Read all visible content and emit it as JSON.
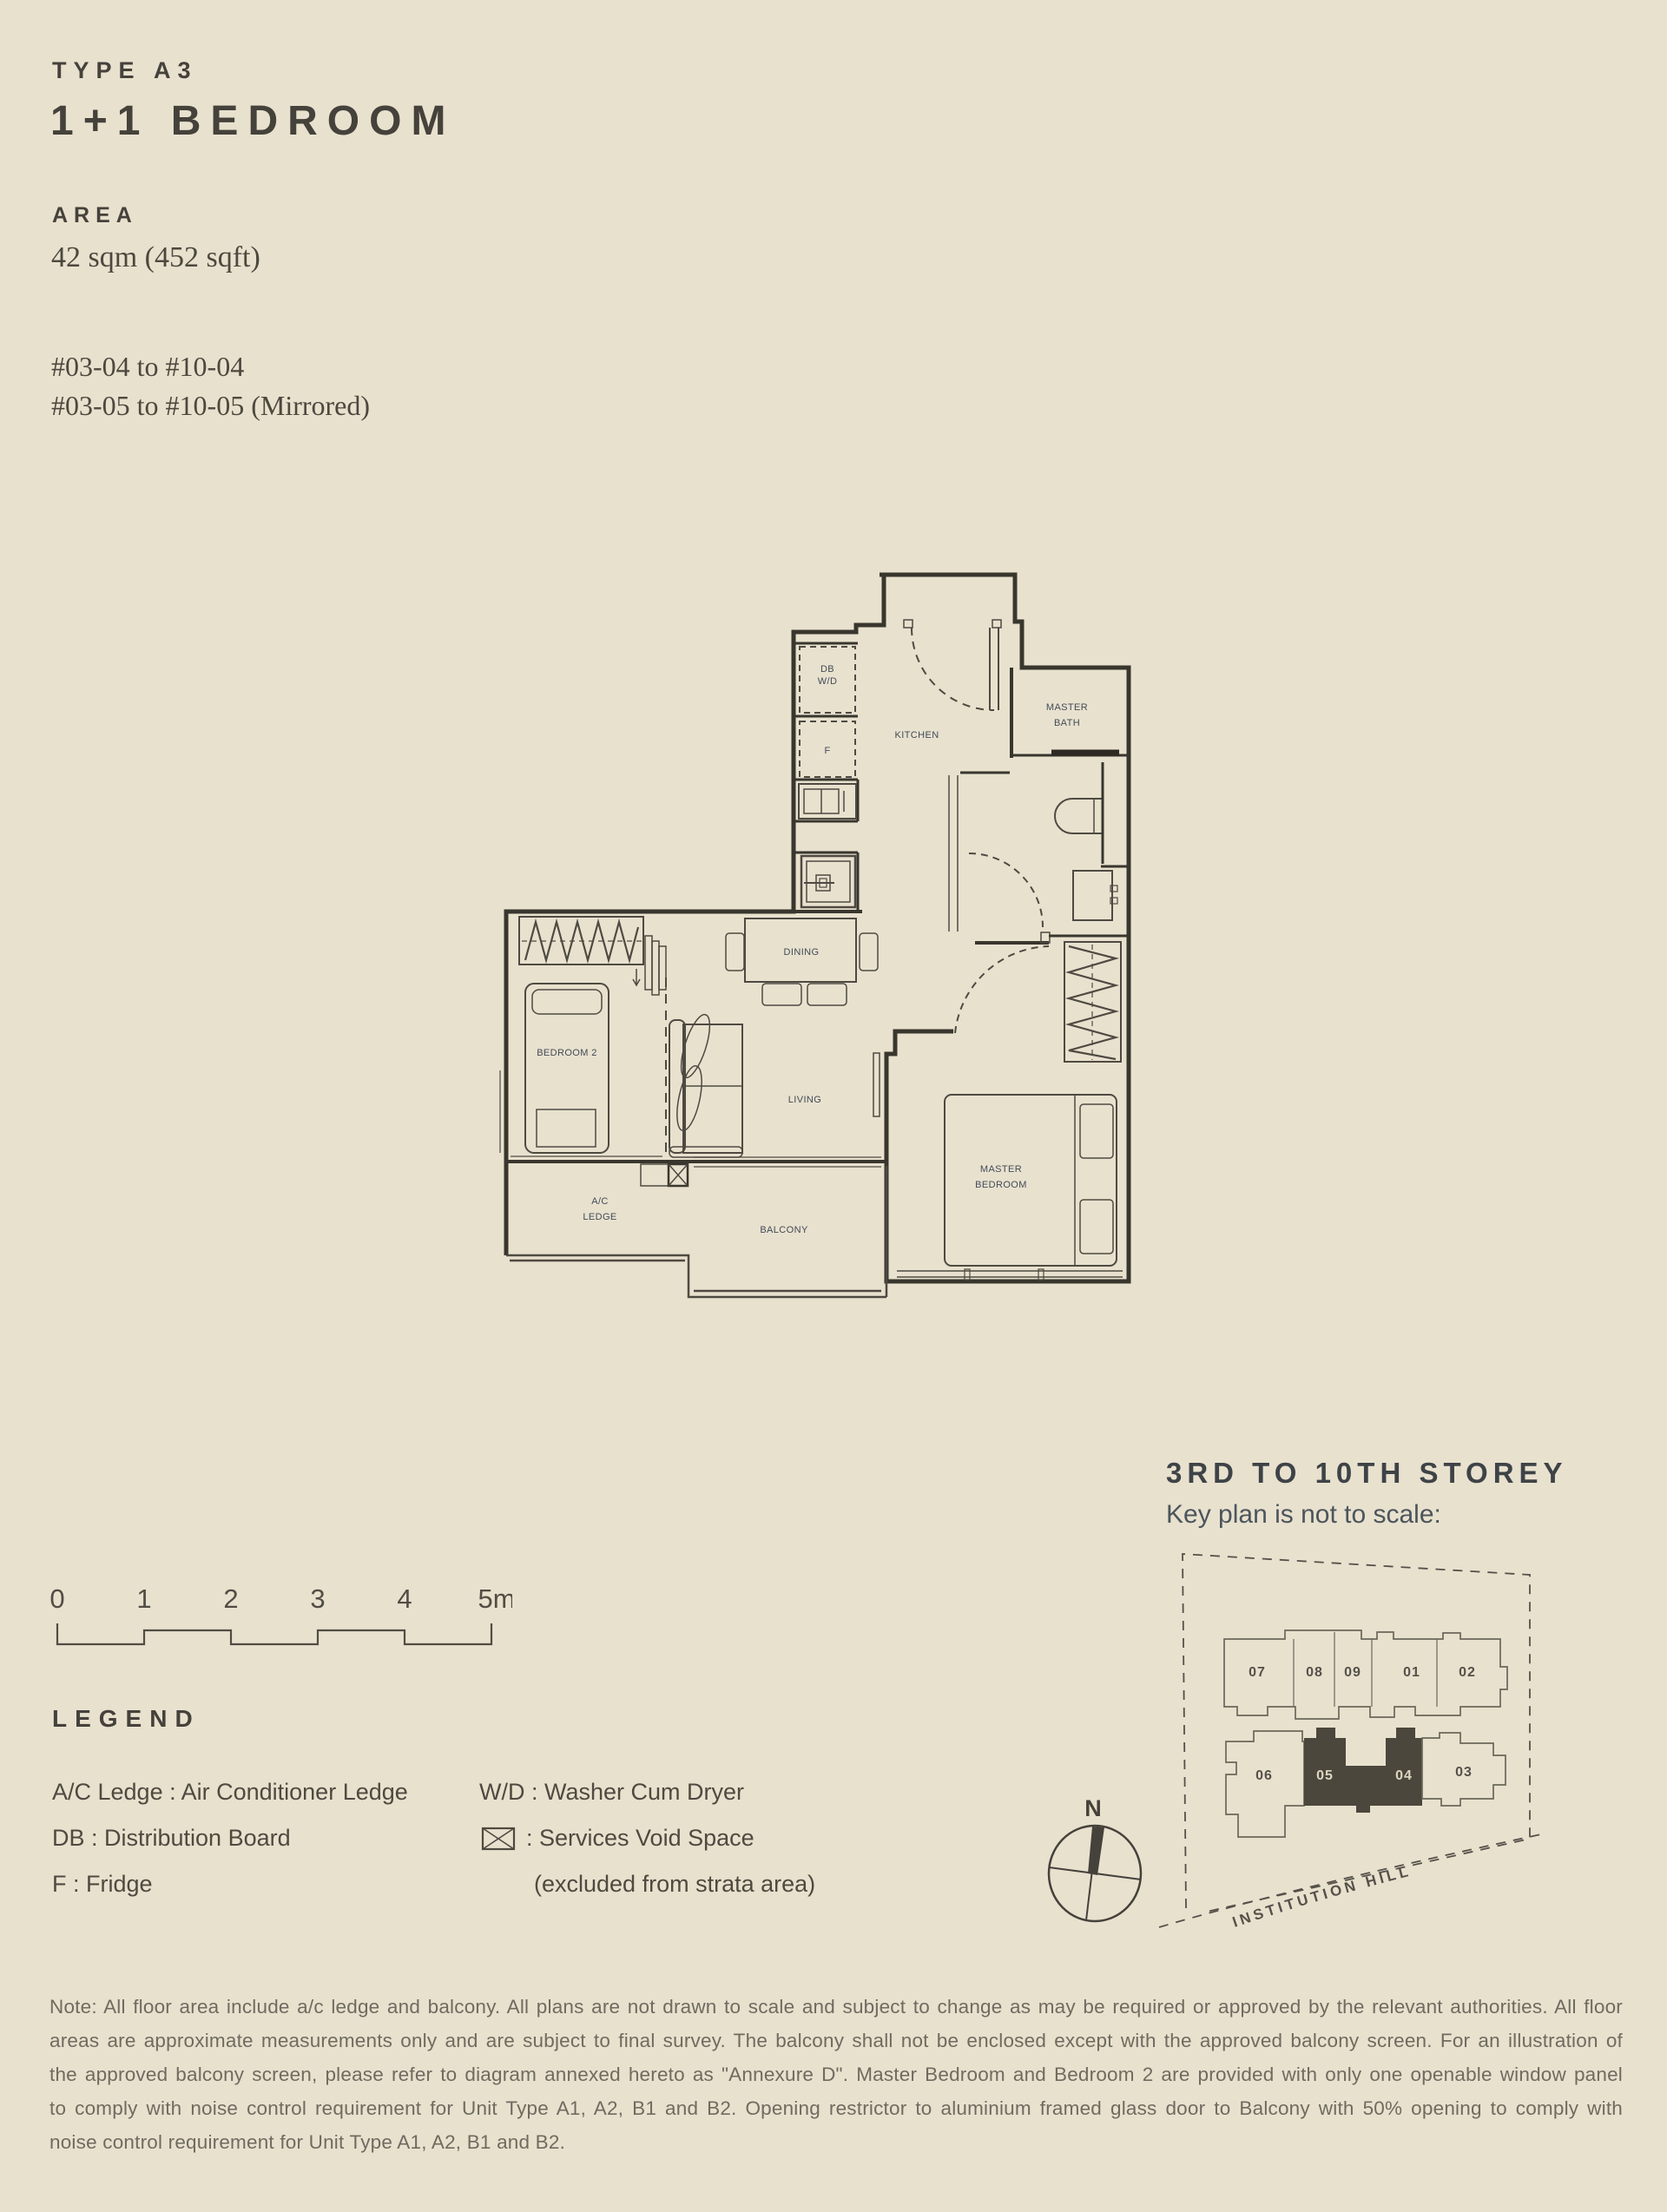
{
  "header": {
    "type_label": "TYPE A3",
    "title": "1+1 BEDROOM",
    "area_heading": "AREA",
    "area_value": "42 sqm (452 sqft)",
    "units_line1": "#03-04 to #10-04",
    "units_line2": "#03-05 to #10-05 (Mirrored)"
  },
  "plan": {
    "rooms": {
      "kitchen": "KITCHEN",
      "master_bath_l1": "MASTER",
      "master_bath_l2": "BATH",
      "dining": "DINING",
      "living": "LIVING",
      "bedroom2": "BEDROOM 2",
      "master_bedroom_l1": "MASTER",
      "master_bedroom_l2": "BEDROOM",
      "ac_ledge_l1": "A/C",
      "ac_ledge_l2": "LEDGE",
      "balcony": "BALCONY",
      "db_l1": "DB",
      "db_l2": "W/D",
      "fridge": "F"
    }
  },
  "keyplan": {
    "heading": "3RD TO 10TH STOREY",
    "subheading": "Key plan is not to scale:",
    "street": "INSTITUTION HILL",
    "units": {
      "u07": "07",
      "u08": "08",
      "u09": "09",
      "u01": "01",
      "u02": "02",
      "u06": "06",
      "u05": "05",
      "u04": "04",
      "u03": "03"
    },
    "highlight_color": "#4b473d"
  },
  "scalebar": {
    "ticks": [
      "0",
      "1",
      "2",
      "3",
      "4",
      "5m"
    ]
  },
  "legend": {
    "heading": "LEGEND",
    "col1": [
      "A/C Ledge : Air Conditioner Ledge",
      "DB : Distribution Board",
      "F : Fridge"
    ],
    "col2_row1": "W/D : Washer Cum Dryer",
    "col2_row2": ": Services Void Space",
    "col2_row3": "(excluded from strata area)"
  },
  "compass": {
    "north_label": "N"
  },
  "note": {
    "lines": [
      "Note: All floor area include a/c ledge and balcony. All plans are not drawn to scale and subject to change as may be required or approved by the relevant authorities. All floor",
      "areas are approximate measurements only and are subject to final survey. The balcony shall not be enclosed except with the approved balcony screen. For an illustration of",
      "the approved balcony screen, please refer to diagram annexed hereto as \"Annexure D\". Master Bedroom and Bedroom 2 are provided with only one openable window panel",
      "to comply with noise control requirement for Unit Type A1, A2, B1 and B2. Opening restrictor to aluminium framed glass door to Balcony with 50% opening to comply with",
      "noise control requirement for Unit Type A1, A2, B1 and B2."
    ]
  }
}
